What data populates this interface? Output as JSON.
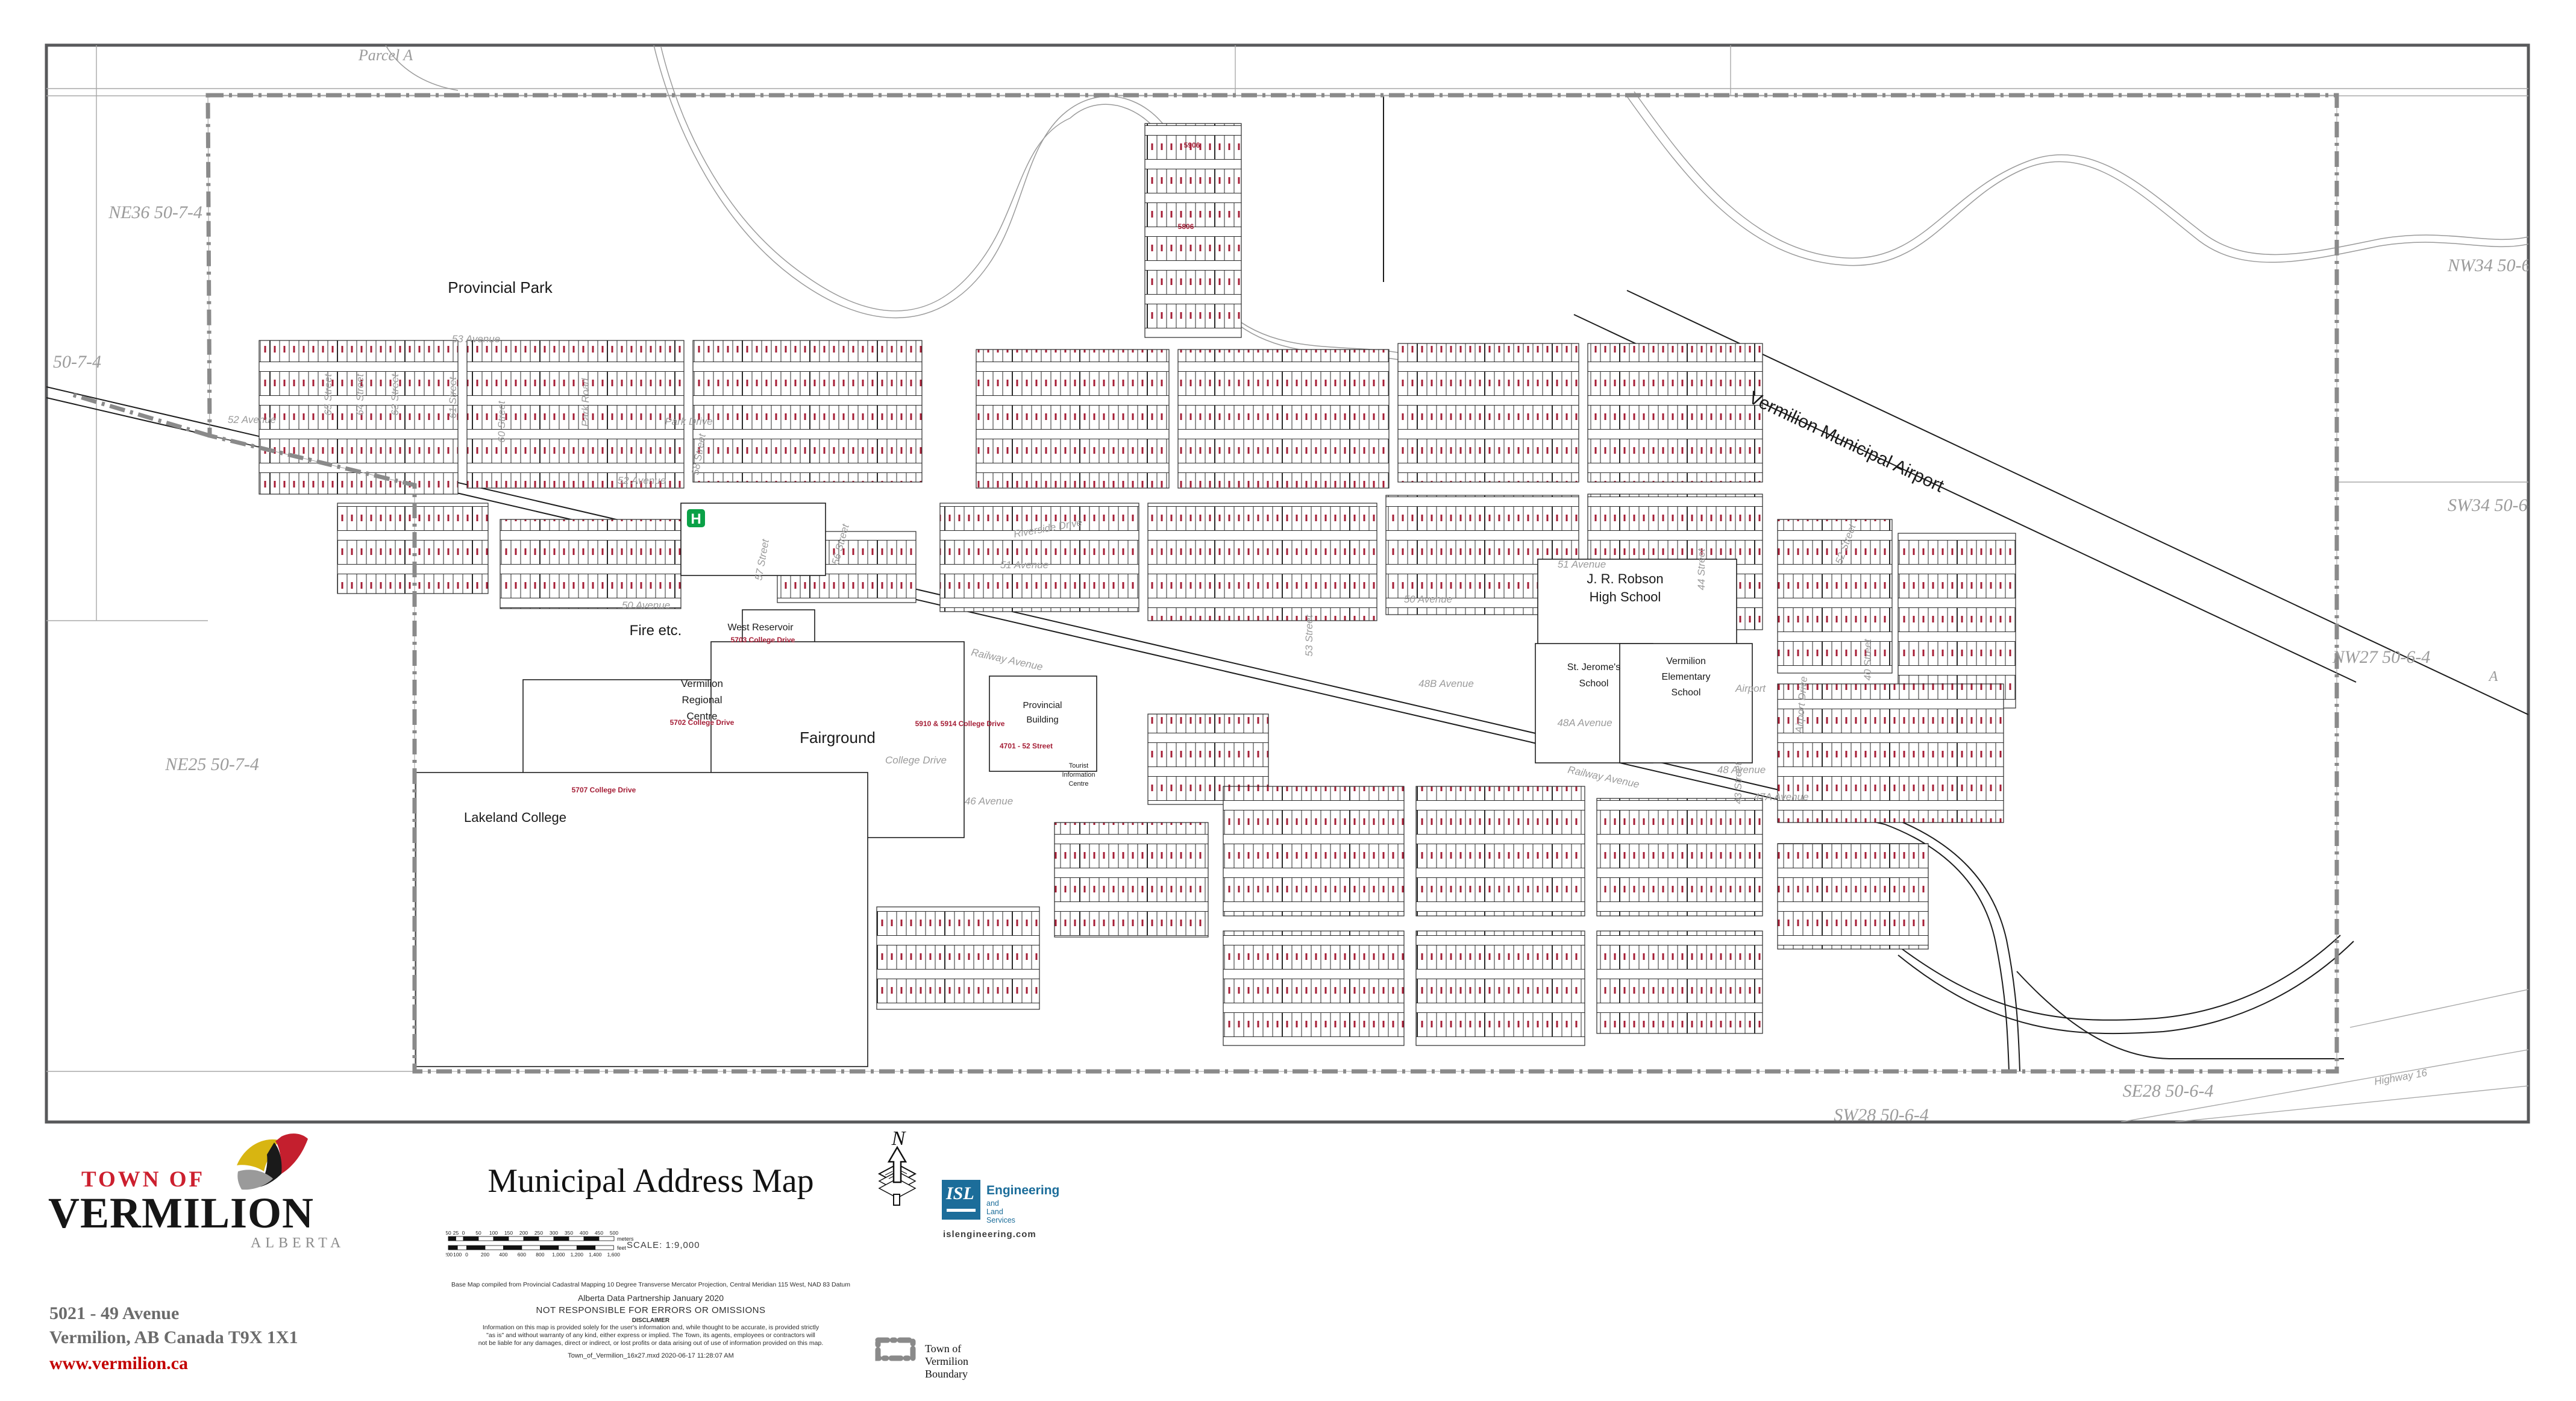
{
  "map": {
    "region_labels": [
      {
        "t": "Parcel A"
      },
      {
        "t": "NE36 50-7-4"
      },
      {
        "t": "50-7-4"
      },
      {
        "t": "NE25 50-7-4"
      },
      {
        "t": "NW34 50-6-4"
      },
      {
        "t": "SW34 50-6-4"
      },
      {
        "t": "NW27 50-6-4"
      },
      {
        "t": "A"
      },
      {
        "t": "SW28 50-6-4"
      },
      {
        "t": "SE28 50-6-4"
      }
    ],
    "street_labels": [
      {
        "t": "53 Avenue"
      },
      {
        "t": "52 Avenue"
      },
      {
        "t": "52 Avenue"
      },
      {
        "t": "51 Avenue"
      },
      {
        "t": "51 Avenue"
      },
      {
        "t": "50 Avenue"
      },
      {
        "t": "50 Avenue"
      },
      {
        "t": "48B Avenue"
      },
      {
        "t": "48A Avenue"
      },
      {
        "t": "48 Avenue"
      },
      {
        "t": "47A Avenue"
      },
      {
        "t": "46 Avenue"
      },
      {
        "t": "College Drive"
      },
      {
        "t": "Railway Avenue"
      },
      {
        "t": "Railway Avenue"
      },
      {
        "t": "Park Drive"
      },
      {
        "t": "Park Road"
      },
      {
        "t": "Riverside Drive"
      },
      {
        "t": "65 Street"
      },
      {
        "t": "64 Street"
      },
      {
        "t": "63 Street"
      },
      {
        "t": "61 Street"
      },
      {
        "t": "60 Street"
      },
      {
        "t": "58 Street"
      },
      {
        "t": "57 Street"
      },
      {
        "t": "56 Street"
      },
      {
        "t": "53 Street"
      },
      {
        "t": "52 Street"
      },
      {
        "t": "44 Street"
      },
      {
        "t": "43 Street"
      },
      {
        "t": "40 Street"
      },
      {
        "t": "Airport Drive"
      },
      {
        "t": "Airport"
      },
      {
        "t": "Highway 16"
      }
    ],
    "facilities": [
      {
        "name": "Provincial Park",
        "lines": [
          "Provincial Park"
        ]
      },
      {
        "name": "Fire etc.",
        "lines": [
          "Fire etc."
        ]
      },
      {
        "name": "West Reservoir",
        "lines": [
          "West Reservoir"
        ]
      },
      {
        "name": "Vermilion Regional Centre",
        "lines": [
          "Vermilion",
          "Regional",
          "Centre"
        ]
      },
      {
        "name": "Fairground",
        "lines": [
          "Fairground"
        ]
      },
      {
        "name": "Provincial Building",
        "lines": [
          "Provincial",
          "Building"
        ]
      },
      {
        "name": "Lakeland College",
        "lines": [
          "Lakeland College"
        ]
      },
      {
        "name": "J. R. Robson High School",
        "lines": [
          "J. R. Robson",
          "High School"
        ]
      },
      {
        "name": "St. Jerome's School",
        "lines": [
          "St. Jerome's",
          "School"
        ]
      },
      {
        "name": "Vermilion Elementary School",
        "lines": [
          "Vermilion",
          "Elementary",
          "School"
        ]
      },
      {
        "name": "Tourist Information Centre",
        "lines": [
          "Tourist",
          "Information",
          "Centre"
        ]
      },
      {
        "name": "Vermilion Municipal Airport",
        "lines": [
          "Vermilion Municipal Airport"
        ]
      }
    ],
    "red_addresses": [
      {
        "t": "5906"
      },
      {
        "t": "5806"
      },
      {
        "t": "5703 College Drive"
      },
      {
        "t": "5702 College Drive"
      },
      {
        "t": "5910 & 5914 College Drive"
      },
      {
        "t": "4701 - 52 Street"
      },
      {
        "t": "5707 College Drive"
      }
    ],
    "hospital_symbol": "H",
    "colors": {
      "boundary": "#8a8a8a",
      "address_red": "#a51e36",
      "hospital_green": "#0aa147",
      "street_label_gray": "#9b9b9b"
    }
  },
  "footer": {
    "logo": {
      "town_of": "TOWN OF",
      "name": "VERMILION",
      "province": "ALBERTA"
    },
    "address_line1": "5021 - 49 Avenue",
    "address_line2": "Vermilion, AB Canada T9X 1X1",
    "website": "www.vermilion.ca",
    "title": "Municipal Address Map",
    "scale_text": "SCALE:  1:9,000",
    "north_label": "N",
    "scale_bar": {
      "meters_ticks": [
        "50",
        "25",
        "0",
        "50",
        "100",
        "150",
        "200",
        "250",
        "300",
        "350",
        "400",
        "450",
        "500"
      ],
      "meters_unit": "meters",
      "feet_ticks": [
        "200",
        "100",
        "0",
        "200",
        "400",
        "600",
        "800",
        "1,000",
        "1,200",
        "1,400",
        "1,600"
      ],
      "feet_unit": "feet"
    },
    "isl": {
      "abbr": "ISL",
      "line1": "Engineering",
      "line2": "and Land Services",
      "url": "islengineering.com"
    },
    "credits": [
      "Base Map compiled from Provincial Cadastral Mapping 10 Degree Transverse Mercator Projection, Central Meridian 115 West, NAD 83 Datum",
      "Alberta Data Partnership January 2020",
      "NOT RESPONSIBLE FOR ERRORS OR OMISSIONS",
      "DISCLAIMER"
    ],
    "disclaimer_lines": [
      "Information on this map is provided solely for the user's information and, while thought to be accurate, is provided strictly",
      "\"as is\" and without warranty of any kind, either express or implied.  The Town, its agents, employees or contractors will",
      "not be liable for any damages, direct or indirect, or lost profits or data arising out of use of information provided on this map."
    ],
    "file_info": "Town_of_Vermilion_16x27.mxd 2020-06-17  11:28:07 AM",
    "legend": {
      "boundary_label": "Town of Vermilion Boundary"
    }
  }
}
